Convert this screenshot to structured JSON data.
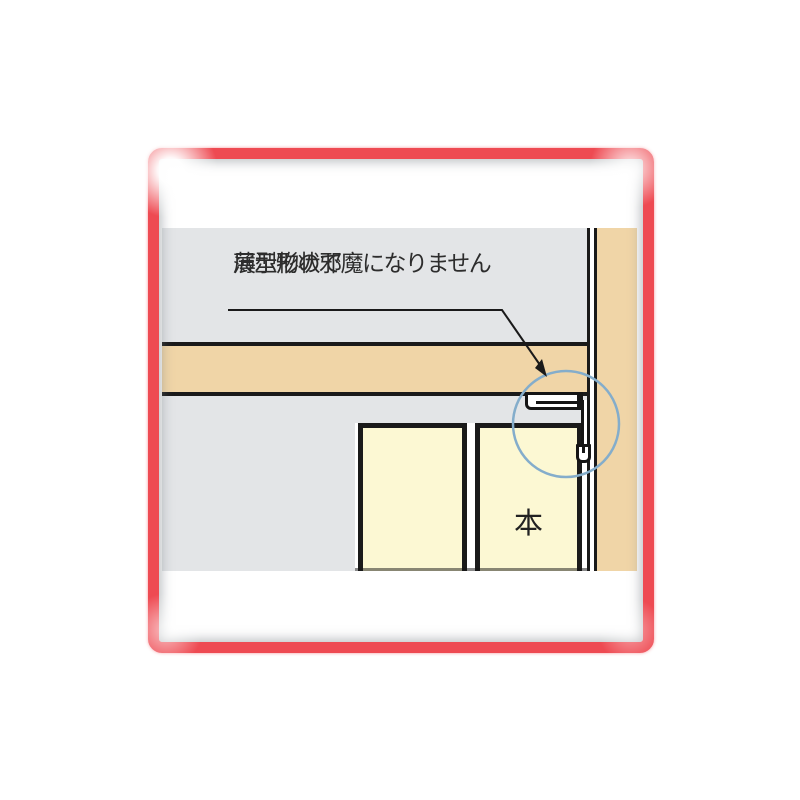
{
  "annotation": {
    "line1": "薄型形状で",
    "line2": "展示物の邪魔になりません"
  },
  "book_label": "本",
  "colors": {
    "frame_red": "#ee4a52",
    "wall_gray": "#e3e5e7",
    "wood_tan": "#f0d5a7",
    "book_yellow": "#fcf8d3",
    "highlight_blue": "#84adcb",
    "outline_black": "#1a1a1a",
    "text_dark": "#2d2d2d"
  }
}
